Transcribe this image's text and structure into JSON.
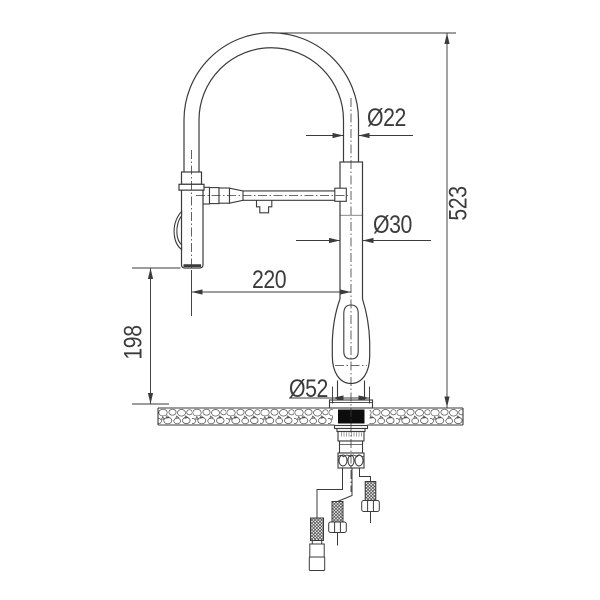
{
  "drawing": {
    "colors": {
      "line": "#3b3b3b",
      "background": "#ffffff",
      "gasket": "#0d0d0d"
    },
    "dimensions": {
      "spout_tube_diameter": {
        "label": "Ø22"
      },
      "riser_diameter": {
        "label": "Ø30"
      },
      "base_diameter": {
        "label": "Ø52"
      },
      "spout_reach": {
        "label": "220"
      },
      "spray_head_height": {
        "label": "198"
      },
      "overall_height": {
        "label": "523"
      }
    }
  }
}
